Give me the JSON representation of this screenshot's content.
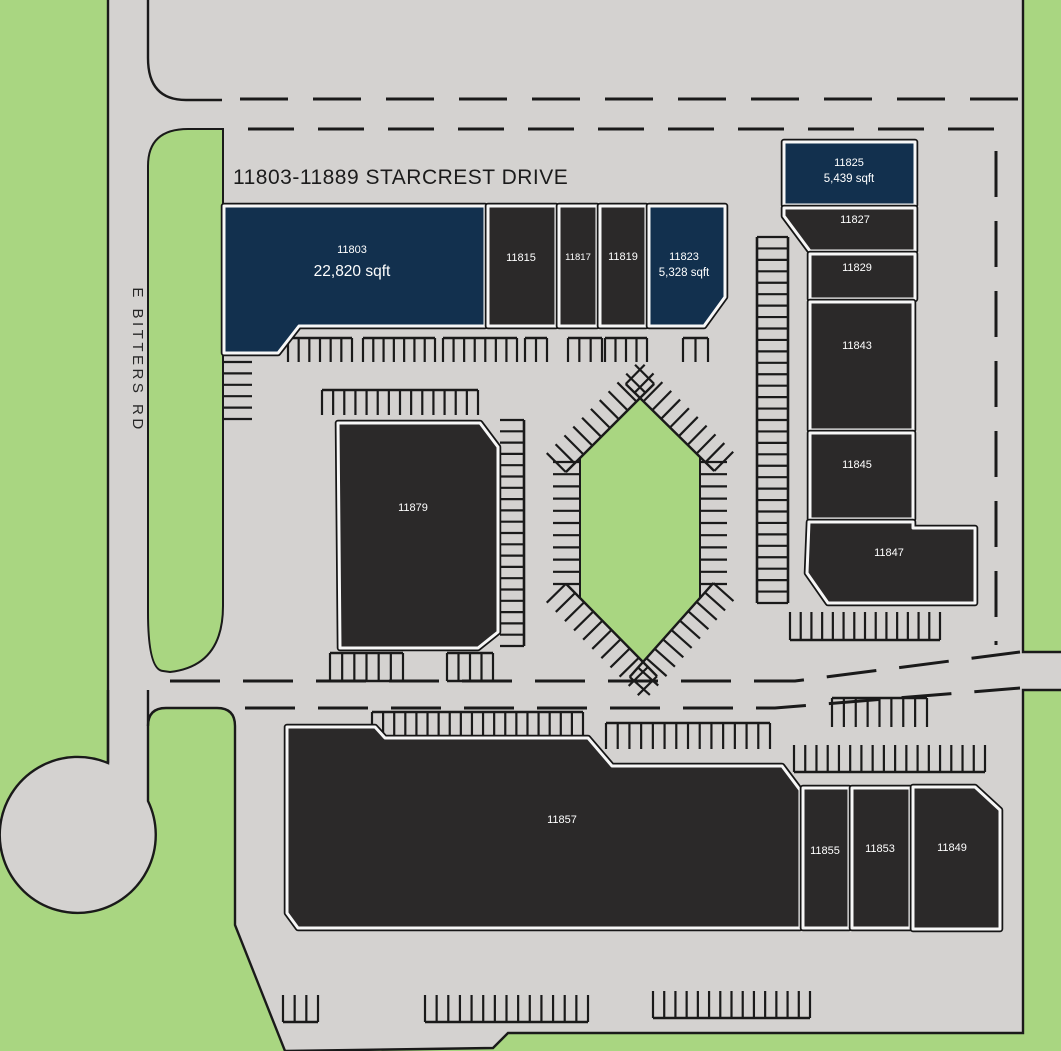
{
  "page": {
    "title": "11803-11889 STARCREST DRIVE",
    "road_label": "E BITTERS RD"
  },
  "colors": {
    "pavement": "#d4d2d0",
    "green": "#a9d681",
    "highlight_navy": "#12304e",
    "building_dark": "#2b2929",
    "line": "#1a1a1a",
    "label_white": "#ffffff"
  },
  "buildings": [
    {
      "number": "11803",
      "sqft": "22,820 sqft",
      "highlighted": true
    },
    {
      "number": "11815",
      "highlighted": false
    },
    {
      "number": "11817",
      "highlighted": false
    },
    {
      "number": "11819",
      "highlighted": false
    },
    {
      "number": "11823",
      "sqft": "5,328 sqft",
      "highlighted": true
    },
    {
      "number": "11825",
      "sqft": "5,439 sqft",
      "highlighted": true
    },
    {
      "number": "11827",
      "highlighted": false
    },
    {
      "number": "11829",
      "highlighted": false
    },
    {
      "number": "11843",
      "highlighted": false
    },
    {
      "number": "11845",
      "highlighted": false
    },
    {
      "number": "11847",
      "highlighted": false
    },
    {
      "number": "11879",
      "highlighted": false
    },
    {
      "number": "11857",
      "highlighted": false
    },
    {
      "number": "11855",
      "highlighted": false
    },
    {
      "number": "11853",
      "highlighted": false
    },
    {
      "number": "11849",
      "highlighted": false
    }
  ]
}
